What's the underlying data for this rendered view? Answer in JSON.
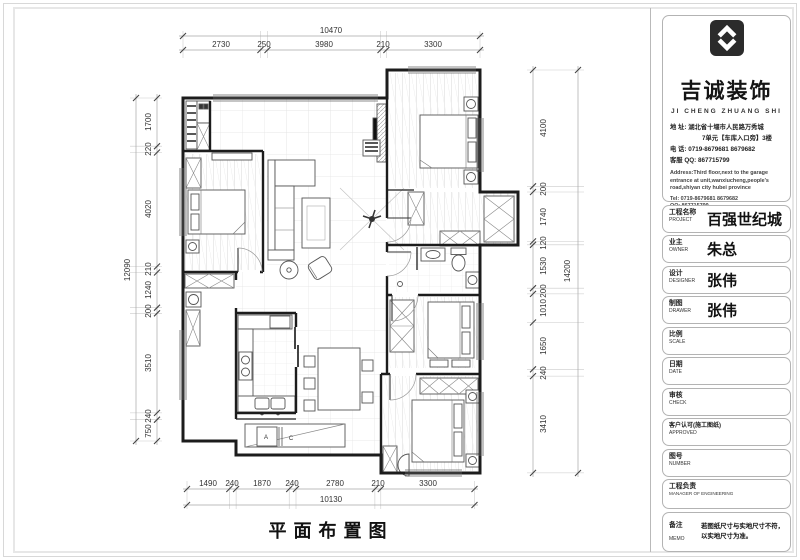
{
  "company": {
    "name_cn": "吉诚装饰",
    "name_en": "JI CHENG ZHUANG SHI",
    "address_lines": [
      "地    址: 湖北省十堰市人民路万秀城",
      "7单元【车库入口旁】3楼",
      "电    话: 0719-8679681   8679682",
      "客服 QQ: 867715799"
    ],
    "address_lines_en": [
      "Address:Third floor,next to the garage",
      "entrance at unit,wanxiucheng,people's",
      "road,shiyan city hubei province",
      "Tel: 0719-8679681    8679682",
      "QQ: 867715799"
    ]
  },
  "title_block": {
    "rows": [
      {
        "label_cn": "工程名称",
        "label_en": "PROJECT",
        "value": "百强世纪城"
      },
      {
        "label_cn": "业主",
        "label_en": "OWNER",
        "value": "朱总"
      },
      {
        "label_cn": "设计",
        "label_en": "DESIGNER",
        "value": "张伟"
      },
      {
        "label_cn": "制图",
        "label_en": "DRAWER",
        "value": "张伟"
      },
      {
        "label_cn": "比例",
        "label_en": "SCALE",
        "value": ""
      },
      {
        "label_cn": "日期",
        "label_en": "DATE",
        "value": ""
      },
      {
        "label_cn": "审核",
        "label_en": "CHECK",
        "value": ""
      },
      {
        "label_cn": "客户认可(施工图纸)",
        "label_en": "APPROVED",
        "value": ""
      },
      {
        "label_cn": "图号",
        "label_en": "NUMBER",
        "value": ""
      },
      {
        "label_cn": "工程负责",
        "label_en": "MANAGER OF ENGINEERING",
        "value": ""
      },
      {
        "label_cn": "备注",
        "label_en": "MEMO",
        "value": "",
        "value_lines": [
          "若图纸尺寸与实地尺寸不符，",
          "以实地尺寸为准。"
        ]
      }
    ]
  },
  "plan": {
    "title": "平面布置图",
    "labels": {
      "a": "A",
      "c": "C"
    },
    "dims": {
      "top_total": "10470",
      "top": [
        "2730",
        "250",
        "3980",
        "210",
        "3300"
      ],
      "bottom": [
        "1490",
        "240",
        "1870",
        "240",
        "2780",
        "210",
        "3300"
      ],
      "bottom_total": "10130",
      "left_total": "12090",
      "left": [
        "1700",
        "220",
        "4020",
        "210",
        "1240",
        "200",
        "3510",
        "240",
        "750"
      ],
      "right": [
        "4100",
        "200",
        "1740",
        "120",
        "1530",
        "200",
        "1010",
        "1650",
        "240",
        "3410"
      ],
      "right_total": "14200"
    }
  }
}
